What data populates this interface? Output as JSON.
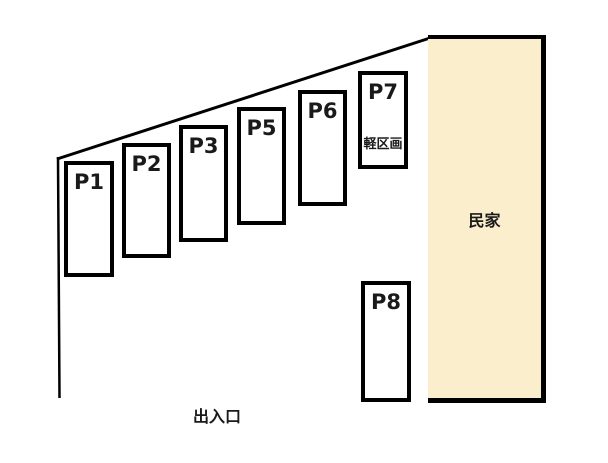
{
  "diagram": {
    "type": "parking-lot-layout",
    "background_color": "#FFFFFF",
    "line_color": "#000000",
    "spots": [
      {
        "id": "p1",
        "label": "P1"
      },
      {
        "id": "p2",
        "label": "P2"
      },
      {
        "id": "p3",
        "label": "P3"
      },
      {
        "id": "p5",
        "label": "P5"
      },
      {
        "id": "p6",
        "label": "P6"
      },
      {
        "id": "p7",
        "label": "P7",
        "note": "軽区画"
      },
      {
        "id": "p8",
        "label": "P8"
      }
    ],
    "house": {
      "label": "民家",
      "fill_color": "#FAEECD",
      "border_color": "#000000"
    },
    "entrance": {
      "label": "出入口"
    }
  }
}
